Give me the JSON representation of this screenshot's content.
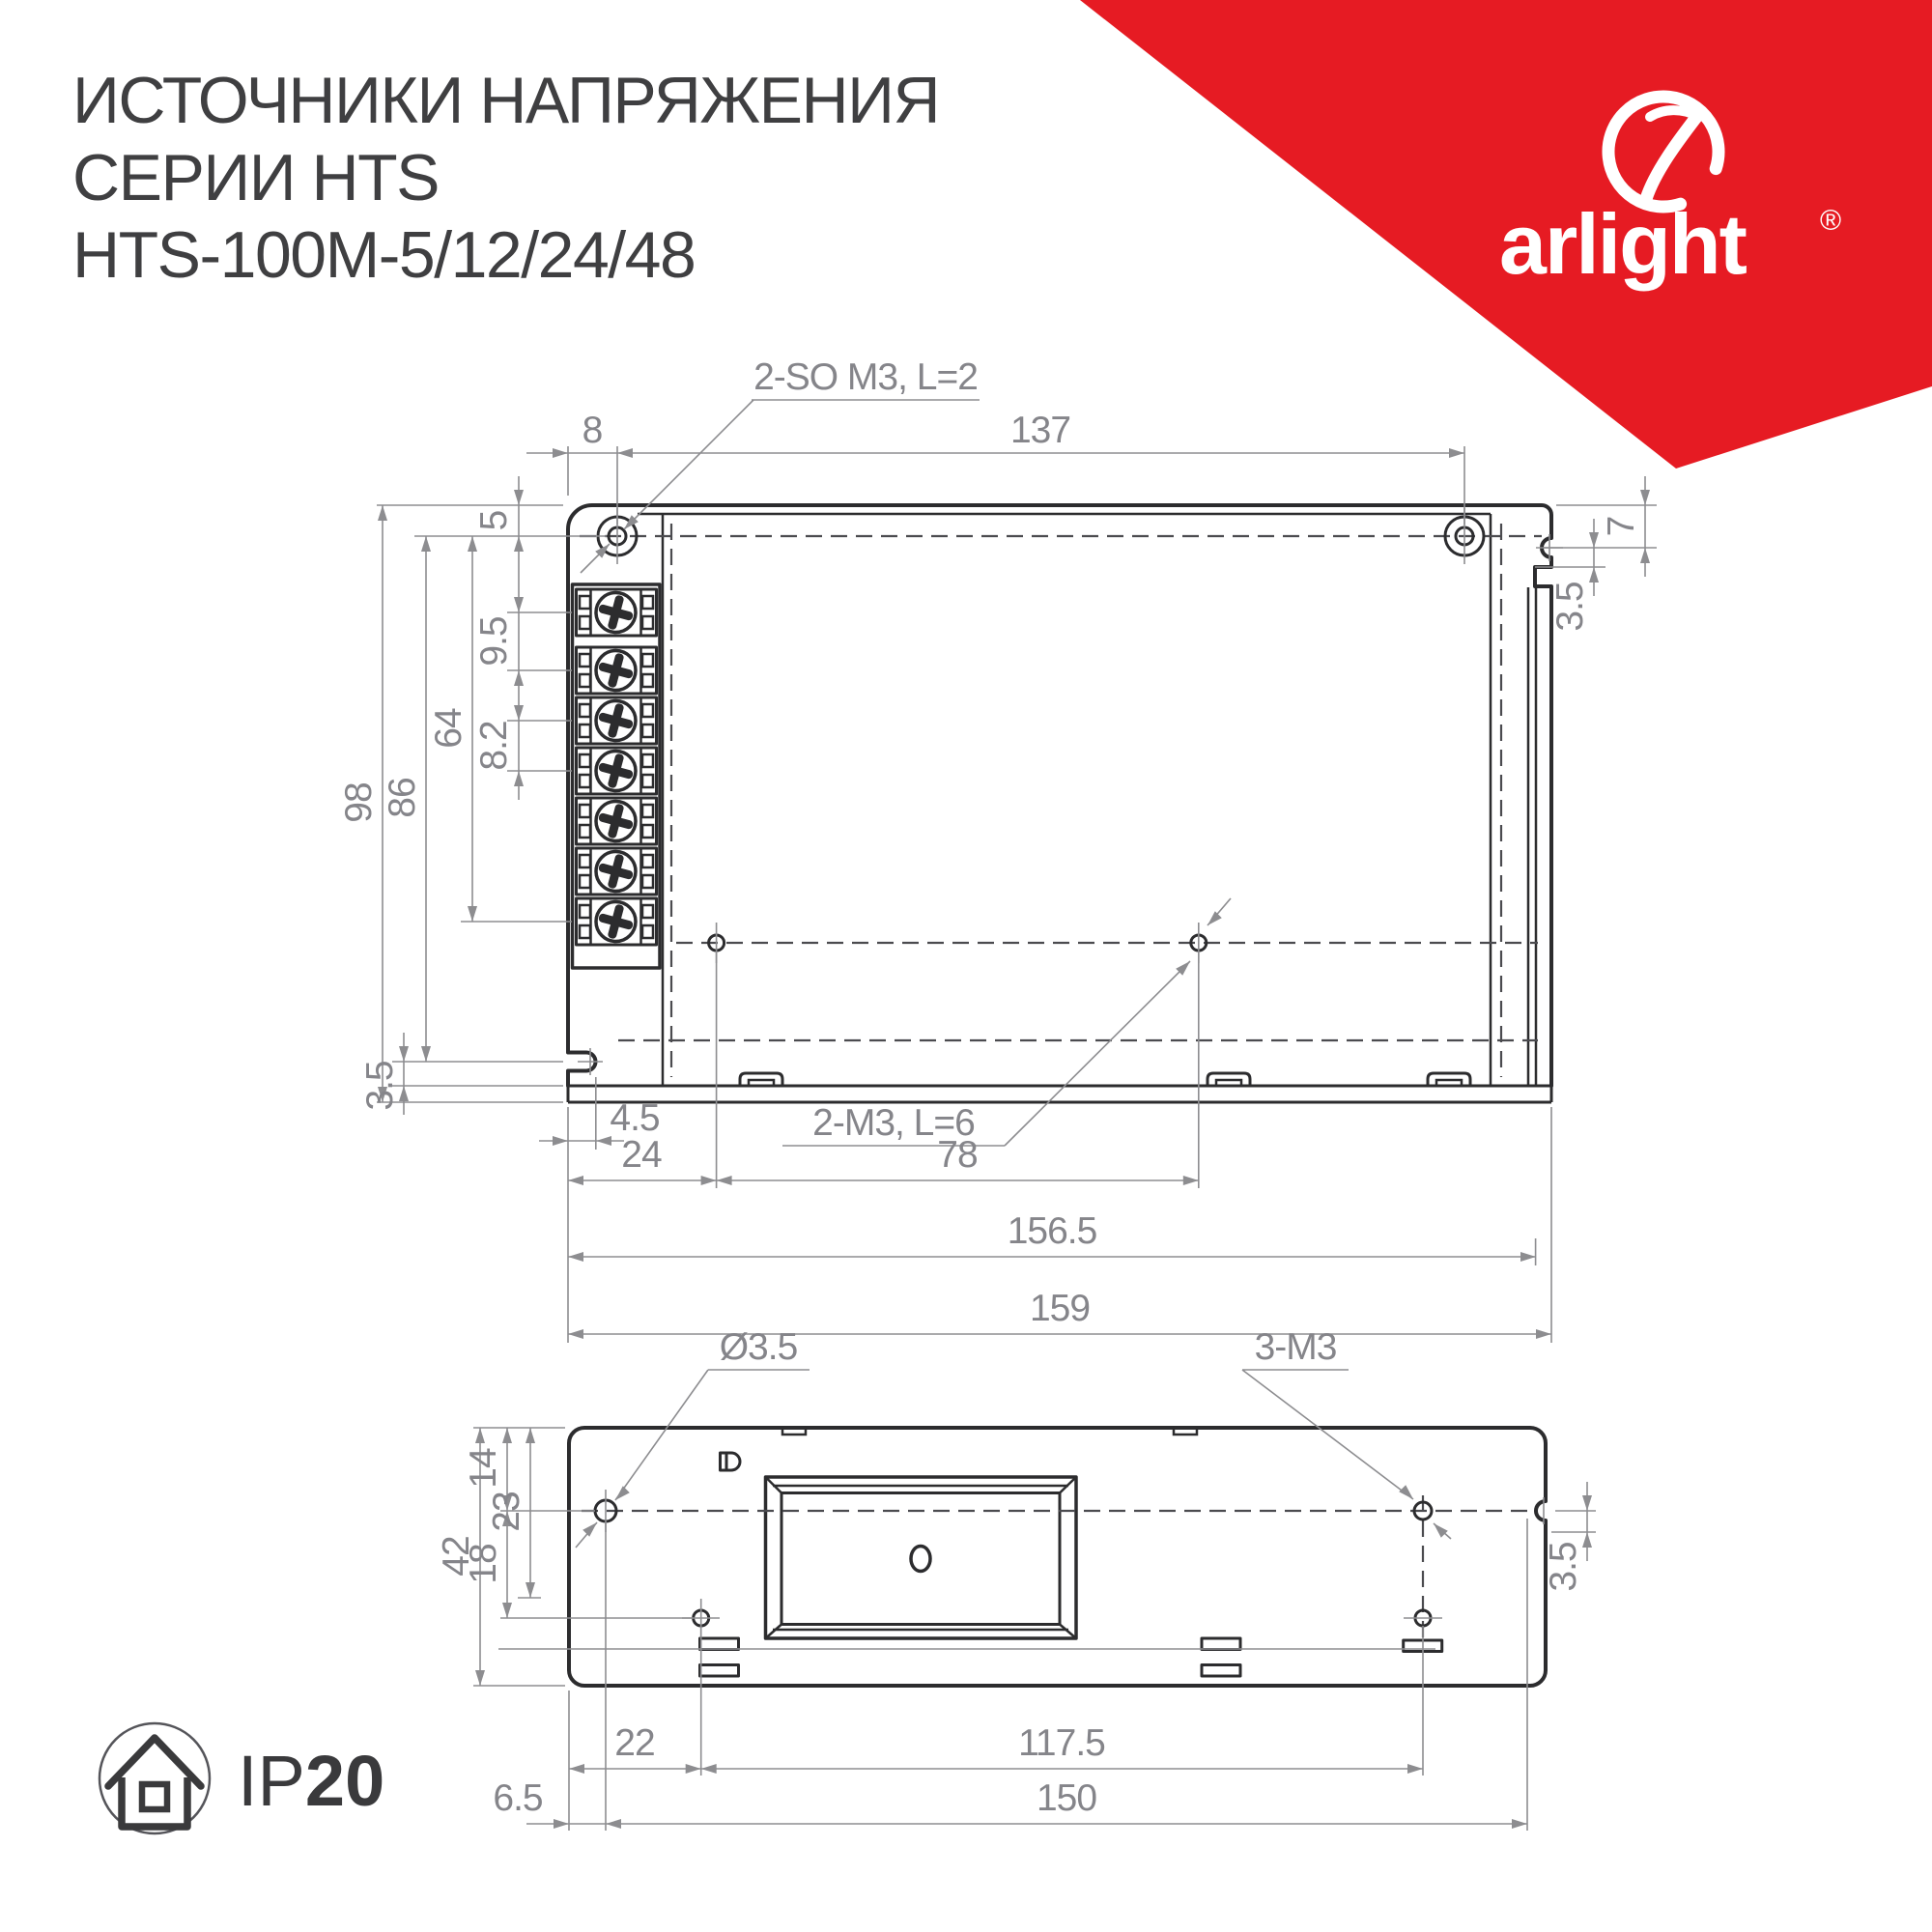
{
  "title": {
    "line1": "ИСТОЧНИКИ НАПРЯЖЕНИЯ",
    "line2": "СЕРИИ HTS",
    "line3": "HTS-100M-5/12/24/48"
  },
  "brand": {
    "name": "arlight",
    "reg": "®",
    "banner_color": "#e61b23"
  },
  "ip_badge": {
    "prefix": "IP",
    "rating": "20"
  },
  "view_top": {
    "callouts": {
      "top": "2-SO M3, L=2",
      "bottom": "2-M3, L=6"
    },
    "dims": {
      "d8": "8",
      "d137": "137",
      "d5": "5",
      "d9_5": "9.5",
      "d8_2": "8.2",
      "d64": "64",
      "d86": "86",
      "d98": "98",
      "d7": "7",
      "d3_5_right": "3.5",
      "d3_5_left": "3.5",
      "d4_5": "4.5",
      "d24": "24",
      "d78": "78",
      "d156_5": "156.5",
      "d159": "159"
    }
  },
  "view_side": {
    "callouts": {
      "hole": "Ø3.5",
      "thread": "3-M3"
    },
    "dims": {
      "d42": "42",
      "d14": "14",
      "d23": "23",
      "d18": "18",
      "d3_5": "3.5",
      "d22": "22",
      "d117_5": "117.5",
      "d6_5": "6.5",
      "d150": "150"
    }
  },
  "colors": {
    "outline": "#2c2c2e",
    "dimension": "#8d8d90",
    "dim_text": "#85858a",
    "title_text": "#3f3f41"
  }
}
